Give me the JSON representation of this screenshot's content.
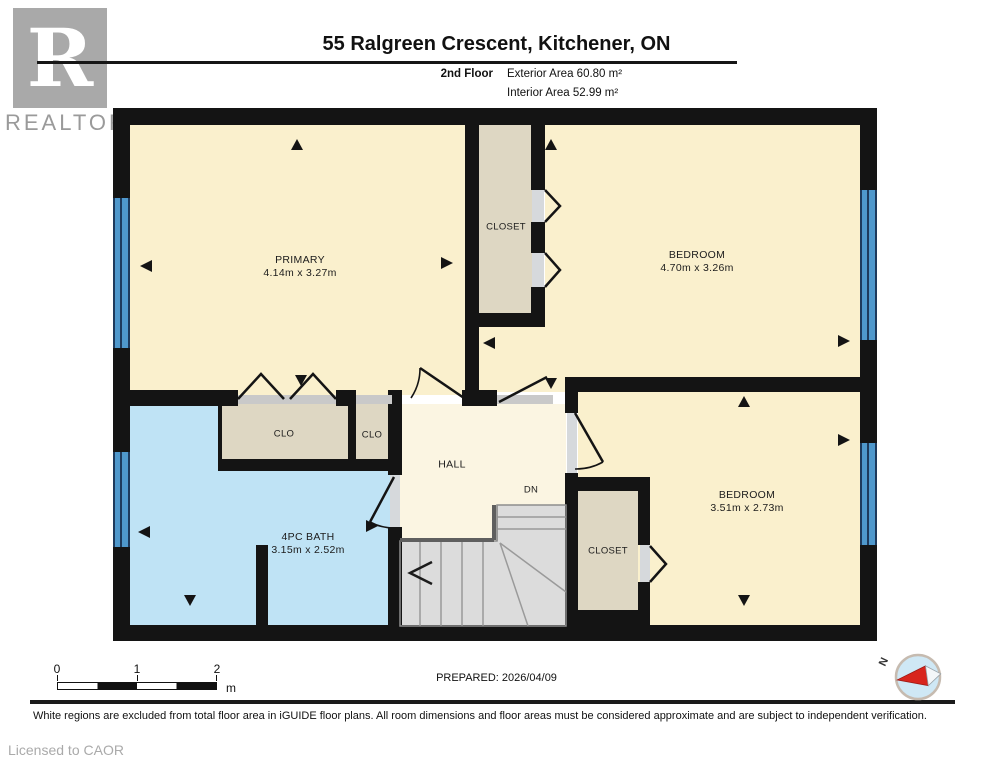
{
  "brand": {
    "logo_letter": "R",
    "logo_text": "REALTOR",
    "registered_mark": "®",
    "licensed_to": "Licensed to CAOR"
  },
  "header": {
    "title": "55 Ralgreen Crescent, Kitchener, ON",
    "floor_label": "2nd Floor",
    "exterior_area": "Exterior Area 60.80 m²",
    "interior_area": "Interior Area 52.99 m²"
  },
  "rooms": {
    "primary": {
      "name": "PRIMARY",
      "dims": "4.14m x 3.27m"
    },
    "closet_top": {
      "name": "CLOSET"
    },
    "bedroom_top_right": {
      "name": "BEDROOM",
      "dims": "4.70m x 3.26m"
    },
    "clo_large": {
      "name": "CLO"
    },
    "clo_small": {
      "name": "CLO"
    },
    "bath": {
      "name": "4PC BATH",
      "dims": "3.15m x 2.52m"
    },
    "hall": {
      "name": "HALL"
    },
    "stairs_down_label": "DN",
    "closet_bottom": {
      "name": "CLOSET"
    },
    "bedroom_bottom_right": {
      "name": "BEDROOM",
      "dims": "3.51m x 2.73m"
    }
  },
  "footer": {
    "scale": {
      "ticks": [
        "0",
        "1",
        "2"
      ],
      "unit": "m"
    },
    "prepared": "PREPARED: 2026/04/09",
    "compass_north": "N",
    "disclaimer": "White regions are excluded from total floor area in iGUIDE floor plans. All room dimensions and floor areas must be considered approximate and are subject to independent verification."
  },
  "colors": {
    "room_fill": "#faf0cd",
    "hall_fill": "#fbf5e2",
    "closet_fill": "#ded7c3",
    "bath_fill": "#bfe3f5",
    "stairs_fill": "#dcdcdc",
    "window_blue": "#4f98cc",
    "wall": "#141414",
    "compass_red": "#d8251d"
  }
}
